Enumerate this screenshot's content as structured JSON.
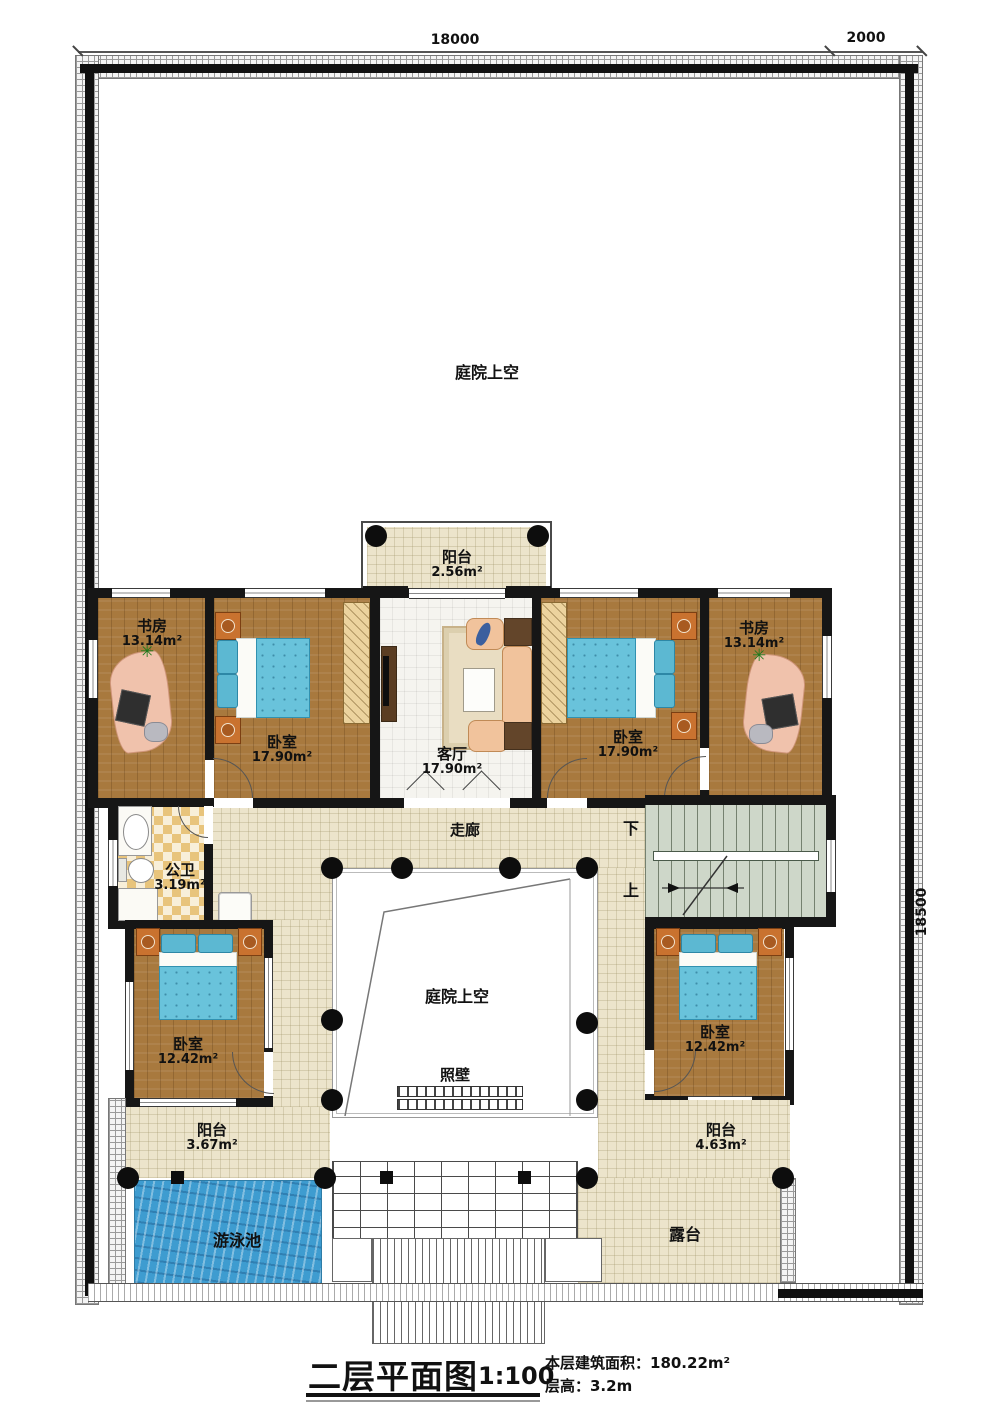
{
  "dimensions": {
    "top_main": "18000",
    "top_right": "2000",
    "right_side": "18500"
  },
  "upper_courtyard": {
    "label": "庭院上空"
  },
  "rooms": {
    "balcony_top": {
      "name": "阳台",
      "area": "2.56m²"
    },
    "study_left": {
      "name": "书房",
      "area": "13.14m²"
    },
    "bedroom_top_left": {
      "name": "卧室",
      "area": "17.90m²"
    },
    "living": {
      "name": "客厅",
      "area": "17.90m²"
    },
    "bedroom_top_right": {
      "name": "卧室",
      "area": "17.90m²"
    },
    "study_right": {
      "name": "书房",
      "area": "13.14m²"
    },
    "corridor": {
      "name": "走廊"
    },
    "bath": {
      "name": "公卫",
      "area": "3.19m²"
    },
    "bedroom_sw": {
      "name": "卧室",
      "area": "12.42m²"
    },
    "bedroom_se": {
      "name": "卧室",
      "area": "12.42m²"
    },
    "balcony_sw": {
      "name": "阳台",
      "area": "3.67m²"
    },
    "balcony_se": {
      "name": "阳台",
      "area": "4.63m²"
    },
    "pool": {
      "name": "游泳池"
    },
    "terrace": {
      "name": "露台"
    }
  },
  "center_courtyard": {
    "label": "庭院上空"
  },
  "screen_wall": {
    "name": "照壁"
  },
  "stairs": {
    "down": "下",
    "up": "上"
  },
  "titleblock": {
    "title": "二层平面图",
    "scale": "1:100",
    "area_line": "本层建筑面积：180.22m²",
    "height_line": "层高：3.2m"
  }
}
